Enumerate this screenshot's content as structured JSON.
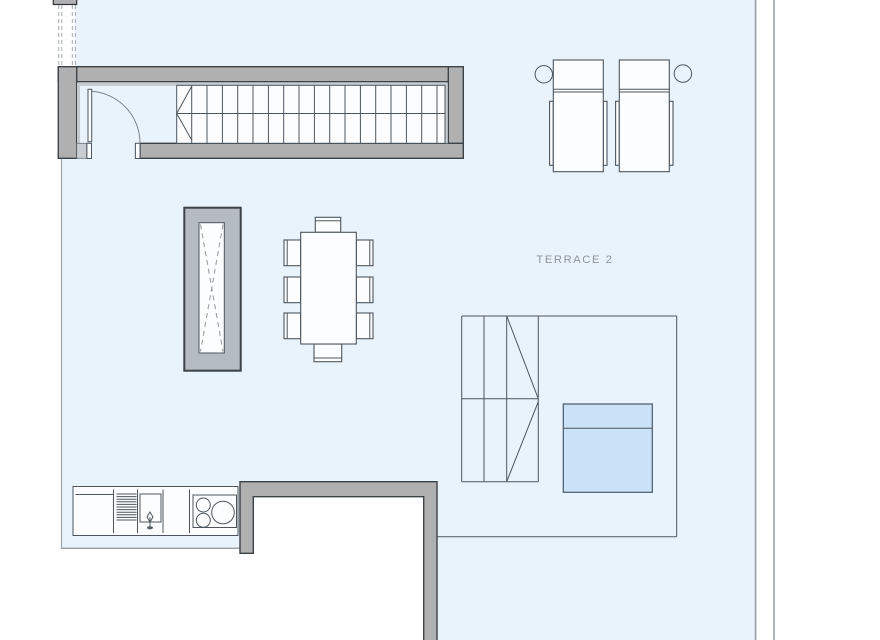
{
  "labels": {
    "terrace": "TERRACE 2"
  },
  "colors": {
    "floor": "#e9f3fb",
    "wall": "#b0b0b0",
    "wall_edge": "#3d4247",
    "lining": "#c6cbcf",
    "chimney": "#b4bbc3",
    "pool": "#cae2f8",
    "pool_edge": "#47586a",
    "line": "#4d565e",
    "light_line": "#9aa0a6",
    "label": "#8d959c",
    "white": "#fcfdfe",
    "arc": "#7c858c"
  }
}
